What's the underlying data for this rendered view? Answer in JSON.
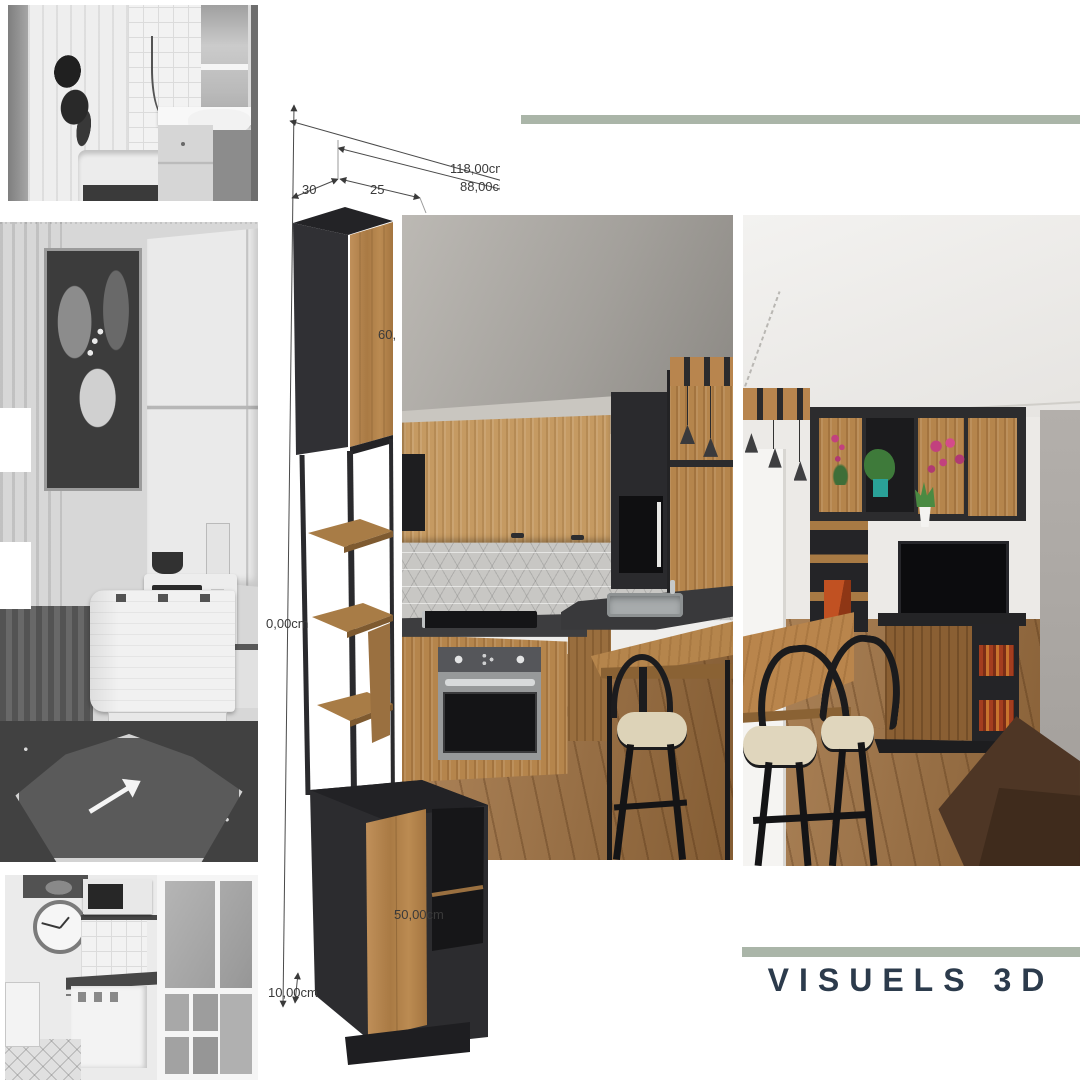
{
  "theme": {
    "accent": "#aab5a8",
    "title_color": "#2c3b4c"
  },
  "title": {
    "text": "VISUELS 3D"
  },
  "drawing": {
    "dim_total_width": "118,00cm",
    "dim_inner_width": "88,00cm",
    "dim_depth": "30",
    "dim_gap": "25",
    "dim_height_ref": "0,00cm",
    "dim_top_door": "60,",
    "dim_bottom_cabinet": "50,00cm",
    "dim_plinth": "10,00cm"
  }
}
